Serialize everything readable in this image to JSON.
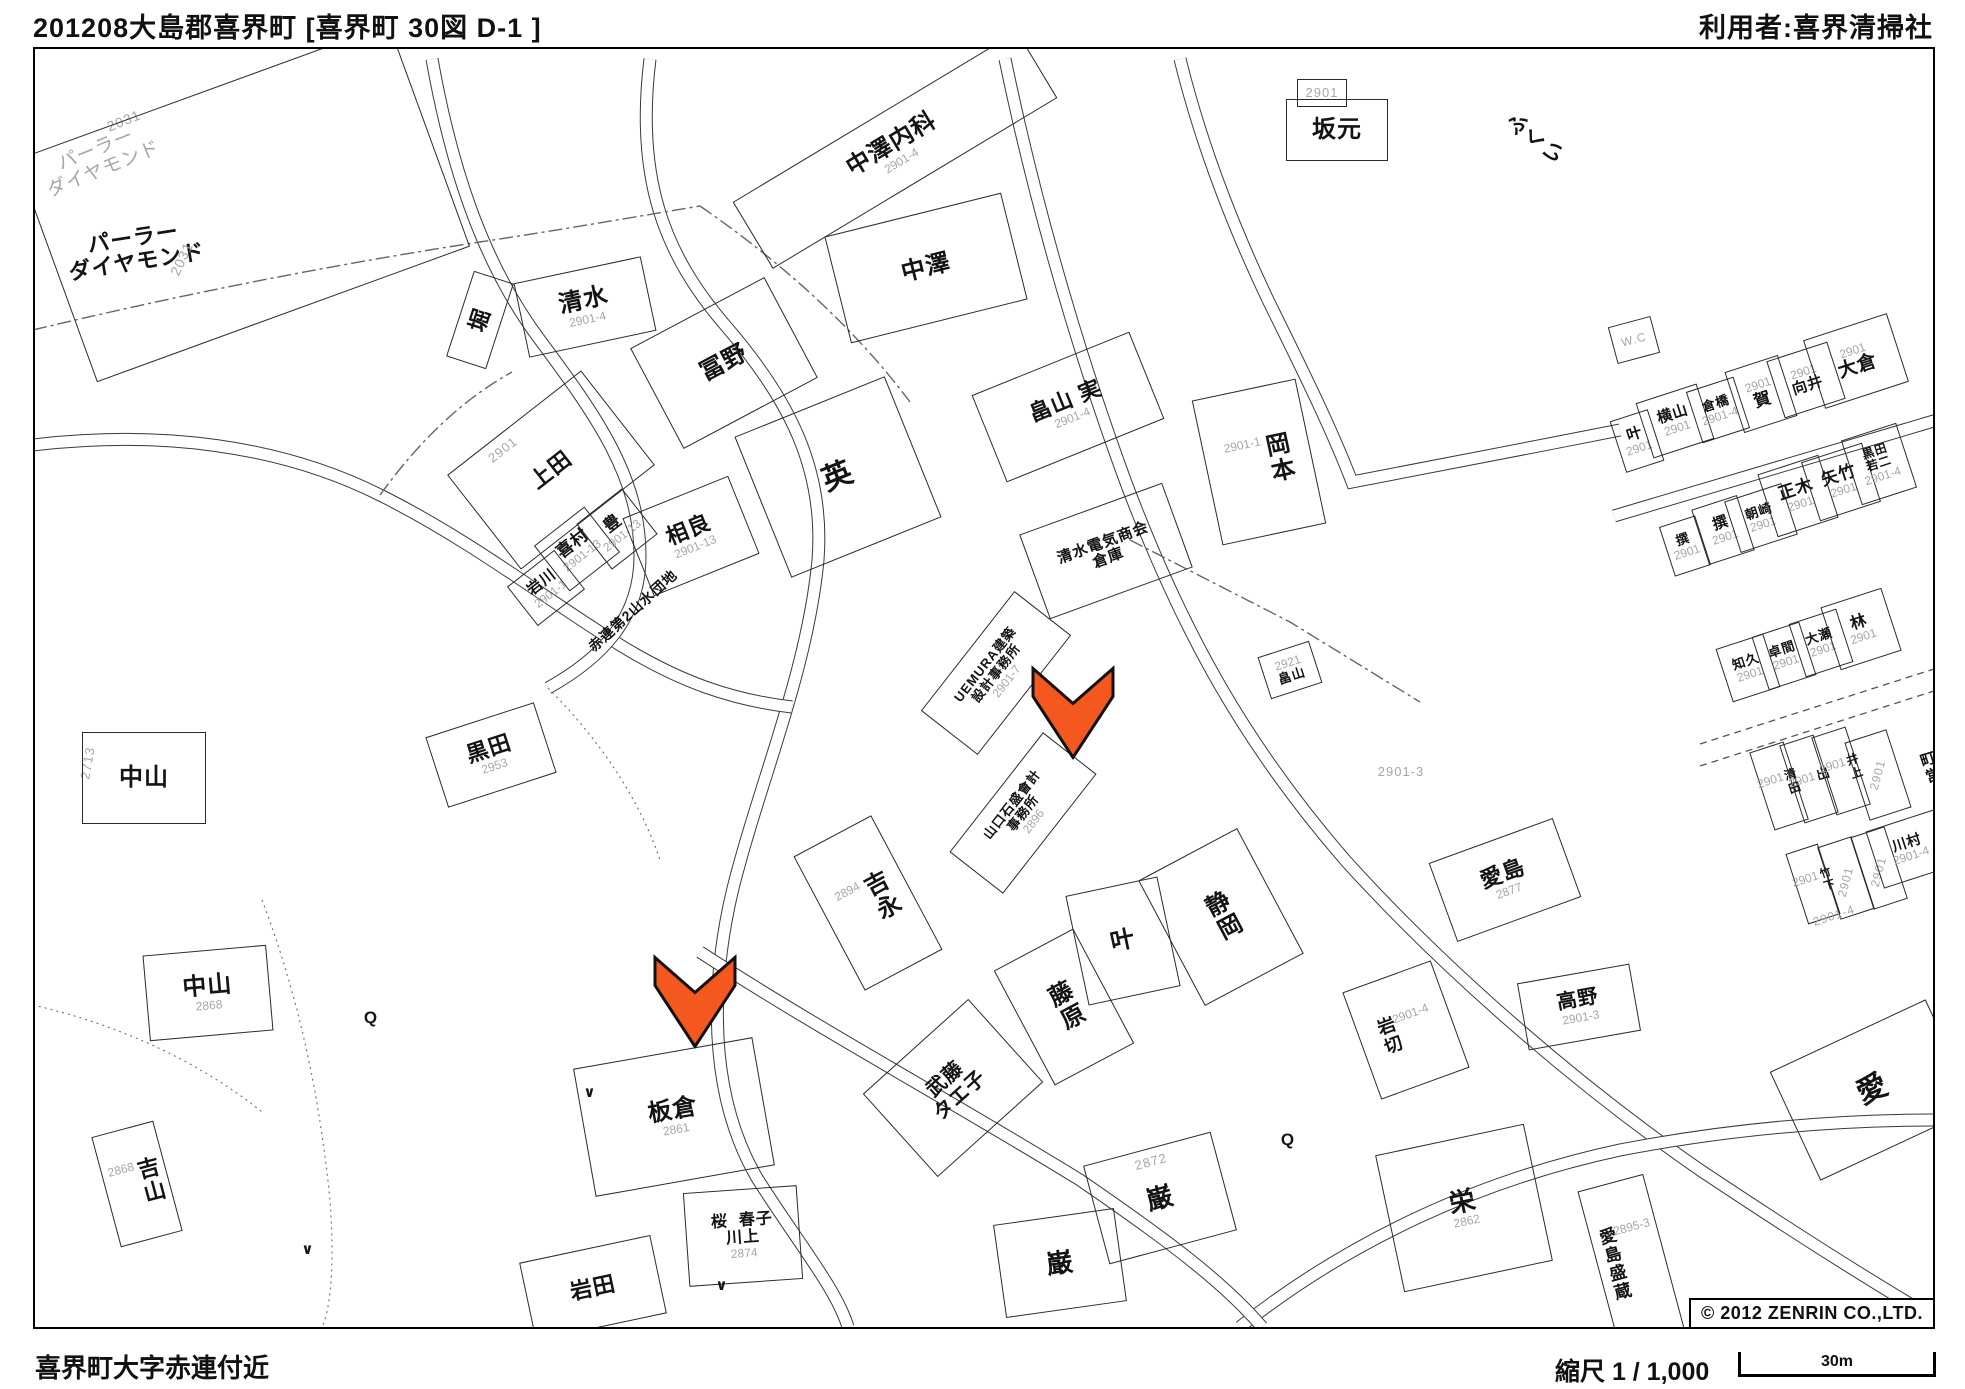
{
  "header": {
    "title_left": "201208大島郡喜界町 [喜界町 30図 D-1 ]",
    "title_right": "利用者:喜界清掃社"
  },
  "footer": {
    "area_name": "喜界町大字赤連付近",
    "scale_text": "縮尺 1 / 1,000",
    "scale_distance": "30m",
    "copyright": "© 2012 ZENRIN CO.,LTD."
  },
  "map": {
    "accent_color": "#f4581f",
    "label_color": "#141414",
    "number_color": "#a6a6a6",
    "arrows": [
      {
        "x": 1073,
        "y": 716
      },
      {
        "x": 695,
        "y": 1005
      }
    ],
    "labels": [
      {
        "t": "パーラー\nダイヤモンド",
        "x": 100,
        "y": 160,
        "r": -22,
        "s": 19,
        "g": true
      },
      {
        "t": "2031",
        "x": 124,
        "y": 121,
        "r": -22,
        "s": 14,
        "g": true
      },
      {
        "t": "",
        "x": 243,
        "y": 203,
        "r": -20,
        "bw": 395,
        "bh": 235
      },
      {
        "t": "パーラー\nダイヤモンド",
        "x": 135,
        "y": 250,
        "r": -9,
        "s": 22
      },
      {
        "t": "2031",
        "x": 182,
        "y": 259,
        "r": -65,
        "s": 14,
        "g": true
      },
      {
        "t": "堀",
        "x": 480,
        "y": 320,
        "r": -72,
        "s": 22,
        "bw": 88,
        "bh": 40
      },
      {
        "t": "清水",
        "n": "2901-4",
        "x": 585,
        "y": 307,
        "r": -12,
        "s": 24,
        "bw": 128,
        "bh": 74
      },
      {
        "t": "冨野",
        "x": 724,
        "y": 363,
        "r": -28,
        "s": 24,
        "bw": 150,
        "bh": 112
      },
      {
        "t": "中澤内科",
        "n": "2901-4",
        "x": 895,
        "y": 150,
        "r": -31,
        "s": 24,
        "bw": 330,
        "bh": 76
      },
      {
        "t": "中澤",
        "x": 926,
        "y": 268,
        "r": -14,
        "s": 24,
        "bw": 180,
        "bh": 108
      },
      {
        "t": "畠山 実",
        "n": "2901-4",
        "x": 1068,
        "y": 407,
        "r": -22,
        "s": 22,
        "bw": 168,
        "bh": 92
      },
      {
        "t": "2901",
        "x": 1322,
        "y": 93,
        "r": 0,
        "s": 13,
        "g": true,
        "bw": 48,
        "bh": 26
      },
      {
        "t": "坂元",
        "x": 1337,
        "y": 130,
        "r": 0,
        "s": 24,
        "bw": 100,
        "bh": 60
      },
      {
        "t": "ふくい",
        "x": 1534,
        "y": 140,
        "r": -52,
        "s": 21,
        "v": true
      },
      {
        "t": "英",
        "x": 838,
        "y": 477,
        "r": -22,
        "s": 30,
        "bw": 160,
        "bh": 150
      },
      {
        "t": "2901",
        "x": 503,
        "y": 450,
        "r": -38,
        "s": 13,
        "g": true
      },
      {
        "t": "上田",
        "x": 551,
        "y": 470,
        "r": -38,
        "s": 22,
        "bw": 168,
        "bh": 118
      },
      {
        "t": "喜村",
        "n": "2901-13",
        "x": 577,
        "y": 549,
        "r": -38,
        "s": 17,
        "bw": 62,
        "bh": 56
      },
      {
        "t": "豊",
        "n": "2901-13",
        "x": 617,
        "y": 529,
        "r": -38,
        "s": 17,
        "bw": 56,
        "bh": 56
      },
      {
        "t": "岩川",
        "n": "2901-1",
        "x": 546,
        "y": 588,
        "r": -38,
        "s": 15,
        "bw": 58,
        "bh": 48
      },
      {
        "t": "相良",
        "n": "2901-13",
        "x": 691,
        "y": 536,
        "r": -22,
        "s": 22,
        "bw": 112,
        "bh": 82
      },
      {
        "t": "赤連第2山水団地",
        "x": 633,
        "y": 611,
        "r": -42,
        "s": 14
      },
      {
        "t": "清水電気商会\n倉庫",
        "x": 1106,
        "y": 551,
        "r": -20,
        "s": 15,
        "bw": 150,
        "bh": 88
      },
      {
        "t": "岡本",
        "n": "2901-1",
        "x": 1259,
        "y": 462,
        "r": -12,
        "s": 24,
        "v": true,
        "bw": 104,
        "bh": 146
      },
      {
        "t": "W.C",
        "x": 1634,
        "y": 340,
        "r": -15,
        "s": 12,
        "g": true,
        "bw": 42,
        "bh": 36
      },
      {
        "t": "叶",
        "n": "2901",
        "x": 1637,
        "y": 441,
        "r": -18,
        "s": 15,
        "bw": 38,
        "bh": 52
      },
      {
        "t": "横山",
        "n": "2901",
        "x": 1675,
        "y": 421,
        "r": -18,
        "s": 15,
        "bw": 62,
        "bh": 56
      },
      {
        "t": "倉橋",
        "n": "2901-4",
        "x": 1718,
        "y": 410,
        "r": -18,
        "s": 13,
        "bw": 48,
        "bh": 52
      },
      {
        "t": "賀",
        "n": "2901",
        "na": true,
        "x": 1761,
        "y": 394,
        "r": -18,
        "s": 17,
        "bw": 54,
        "bh": 62
      },
      {
        "t": "向井",
        "n": "2901",
        "na": true,
        "x": 1806,
        "y": 380,
        "r": -18,
        "s": 15,
        "bw": 62,
        "bh": 58
      },
      {
        "t": "大倉",
        "n": "2901",
        "na": true,
        "x": 1856,
        "y": 361,
        "r": -18,
        "s": 19,
        "bw": 86,
        "bh": 70
      },
      {
        "t": "撰",
        "n": "2901",
        "x": 1685,
        "y": 546,
        "r": -18,
        "s": 13,
        "bw": 36,
        "bh": 50
      },
      {
        "t": "撰",
        "n": "2901",
        "x": 1723,
        "y": 530,
        "r": -18,
        "s": 15,
        "bw": 46,
        "bh": 56
      },
      {
        "t": "朝崎",
        "n": "2901",
        "x": 1761,
        "y": 518,
        "r": -18,
        "s": 13,
        "bw": 58,
        "bh": 52
      },
      {
        "t": "正木",
        "n": "2901",
        "x": 1798,
        "y": 496,
        "r": -18,
        "s": 17,
        "bw": 62,
        "bh": 64
      },
      {
        "t": "矢竹",
        "n": "2901",
        "x": 1841,
        "y": 482,
        "r": -18,
        "s": 17,
        "bw": 62,
        "bh": 60
      },
      {
        "t": "黒田\n若二",
        "n": "2901-4",
        "x": 1879,
        "y": 464,
        "r": -18,
        "s": 12,
        "bw": 56,
        "bh": 66
      },
      {
        "t": "知久",
        "n": "2901",
        "x": 1748,
        "y": 668,
        "r": -18,
        "s": 13,
        "bw": 48,
        "bh": 54
      },
      {
        "t": "卓間",
        "n": "2901",
        "x": 1784,
        "y": 656,
        "r": -18,
        "s": 13,
        "bw": 48,
        "bh": 54
      },
      {
        "t": "大瀬",
        "n": "2901",
        "x": 1821,
        "y": 643,
        "r": -18,
        "s": 13,
        "bw": 48,
        "bh": 54
      },
      {
        "t": "林",
        "n": "2901",
        "x": 1861,
        "y": 629,
        "r": -18,
        "s": 16,
        "bw": 62,
        "bh": 64
      },
      {
        "t": "清田",
        "n": "2901",
        "x": 1779,
        "y": 786,
        "r": -18,
        "s": 12,
        "v": true,
        "bw": 34,
        "bh": 80
      },
      {
        "t": "出",
        "n": "2901",
        "x": 1809,
        "y": 779,
        "r": -18,
        "s": 13,
        "v": true,
        "bw": 34,
        "bh": 80
      },
      {
        "t": "井上",
        "n": "2901",
        "x": 1841,
        "y": 771,
        "r": -18,
        "s": 12,
        "v": true,
        "bw": 34,
        "bh": 80
      },
      {
        "t": "",
        "x": 1878,
        "y": 775,
        "r": -18,
        "bw": 42,
        "bh": 80
      },
      {
        "t": "2901",
        "x": 1878,
        "y": 775,
        "r": -75,
        "s": 12,
        "g": true
      },
      {
        "t": "町営",
        "x": 1929,
        "y": 768,
        "r": -18,
        "s": 15,
        "v": true
      },
      {
        "t": "竹下",
        "n": "2901",
        "x": 1813,
        "y": 884,
        "r": -18,
        "s": 11,
        "v": true,
        "bw": 32,
        "bh": 72
      },
      {
        "t": "",
        "x": 1846,
        "y": 878,
        "r": -18,
        "bw": 34,
        "bh": 74
      },
      {
        "t": "2901",
        "x": 1846,
        "y": 882,
        "r": -75,
        "s": 12,
        "g": true
      },
      {
        "t": "",
        "x": 1879,
        "y": 868,
        "r": -18,
        "bw": 34,
        "bh": 74
      },
      {
        "t": "2901",
        "x": 1879,
        "y": 872,
        "r": -75,
        "s": 12,
        "g": true
      },
      {
        "t": "川村",
        "n": "2901-4",
        "x": 1909,
        "y": 849,
        "r": -18,
        "s": 14,
        "bw": 70,
        "bh": 58
      },
      {
        "t": "2901-4",
        "x": 1834,
        "y": 916,
        "r": -18,
        "s": 12,
        "g": true
      },
      {
        "t": "2901-3",
        "x": 1401,
        "y": 772,
        "r": 0,
        "s": 13,
        "g": true
      },
      {
        "t": "愛島",
        "n": "2877",
        "x": 1505,
        "y": 880,
        "r": -20,
        "s": 22,
        "bw": 130,
        "bh": 82
      },
      {
        "t": "高野",
        "n": "2901-3",
        "x": 1579,
        "y": 1007,
        "r": -10,
        "s": 20,
        "bw": 112,
        "bh": 66
      },
      {
        "t": "岩切",
        "n": "2901-4",
        "na": true,
        "x": 1406,
        "y": 1030,
        "r": -20,
        "s": 18,
        "v": true,
        "bw": 92,
        "bh": 112
      },
      {
        "t": "愛",
        "x": 1873,
        "y": 1090,
        "r": -25,
        "s": 30,
        "bw": 170,
        "bh": 118
      },
      {
        "t": "栄",
        "n": "2862",
        "x": 1464,
        "y": 1208,
        "r": -12,
        "s": 26,
        "bw": 150,
        "bh": 138
      },
      {
        "t": "愛島盛蔵",
        "n": "2895-3",
        "na": true,
        "x": 1631,
        "y": 1260,
        "r": -15,
        "s": 17,
        "v": true,
        "bw": 66,
        "bh": 158
      },
      {
        "t": "黒田",
        "n": "2953",
        "x": 491,
        "y": 755,
        "r": -18,
        "s": 22,
        "bw": 112,
        "bh": 72
      },
      {
        "t": "2713",
        "x": 88,
        "y": 763,
        "r": -80,
        "s": 13,
        "g": true
      },
      {
        "t": "中山",
        "x": 144,
        "y": 778,
        "r": 0,
        "s": 24,
        "bw": 122,
        "bh": 90
      },
      {
        "t": "吉永",
        "n": "2894",
        "x": 868,
        "y": 903,
        "r": -28,
        "s": 24,
        "v": true,
        "bw": 86,
        "bh": 150
      },
      {
        "t": "UEMURA建築\n設計事務所",
        "n": "2901-7",
        "x": 996,
        "y": 673,
        "r": -52,
        "s": 13,
        "bw": 150,
        "bh": 70
      },
      {
        "t": "山口石盛會計\n事務所",
        "n": "2896",
        "x": 1023,
        "y": 813,
        "r": -52,
        "s": 13,
        "bw": 150,
        "bh": 66
      },
      {
        "t": "叶",
        "x": 1123,
        "y": 941,
        "r": -12,
        "s": 24,
        "bw": 92,
        "bh": 110
      },
      {
        "t": "静岡",
        "x": 1221,
        "y": 917,
        "r": -28,
        "s": 24,
        "v": true,
        "bw": 110,
        "bh": 140
      },
      {
        "t": "藤原",
        "x": 1064,
        "y": 1007,
        "r": -28,
        "s": 24,
        "v": true,
        "bw": 88,
        "bh": 128
      },
      {
        "t": "武藤\nタエ子",
        "x": 953,
        "y": 1088,
        "r": -42,
        "s": 20,
        "bw": 140,
        "bh": 110
      },
      {
        "t": "中山",
        "n": "2868",
        "x": 208,
        "y": 993,
        "r": -5,
        "s": 24,
        "bw": 122,
        "bh": 84
      },
      {
        "t": "吉山",
        "n": "2868",
        "x": 137,
        "y": 1184,
        "r": -15,
        "s": 22,
        "v": true,
        "bw": 62,
        "bh": 112
      },
      {
        "t": "板倉",
        "n": "2861",
        "x": 674,
        "y": 1117,
        "r": -10,
        "s": 24,
        "bw": 180,
        "bh": 128
      },
      {
        "t": "桜  春子\n川上",
        "n": "2874",
        "x": 743,
        "y": 1236,
        "r": -4,
        "s": 16,
        "bw": 112,
        "bh": 92
      },
      {
        "t": "岩田",
        "x": 593,
        "y": 1288,
        "r": -12,
        "s": 22,
        "bw": 132,
        "bh": 78
      },
      {
        "t": "巌",
        "x": 1160,
        "y": 1198,
        "r": -15,
        "s": 26,
        "bw": 130,
        "bh": 100
      },
      {
        "t": "巌",
        "x": 1060,
        "y": 1263,
        "r": -8,
        "s": 26,
        "bw": 120,
        "bh": 92
      },
      {
        "t": "2872",
        "x": 1151,
        "y": 1162,
        "r": -15,
        "s": 13,
        "g": true
      },
      {
        "t": "畠山",
        "n": "2921",
        "na": true,
        "x": 1290,
        "y": 670,
        "r": -18,
        "s": 13,
        "bw": 52,
        "bh": 42
      },
      {
        "t": "Q",
        "x": 371,
        "y": 1018,
        "r": 0,
        "s": 17
      },
      {
        "t": "Q",
        "x": 1288,
        "y": 1140,
        "r": 0,
        "s": 17
      },
      {
        "t": "∨",
        "x": 590,
        "y": 1093,
        "r": 0,
        "s": 15
      },
      {
        "t": "∨",
        "x": 722,
        "y": 1286,
        "r": 0,
        "s": 15
      },
      {
        "t": "∨",
        "x": 308,
        "y": 1250,
        "r": 0,
        "s": 15
      }
    ]
  }
}
